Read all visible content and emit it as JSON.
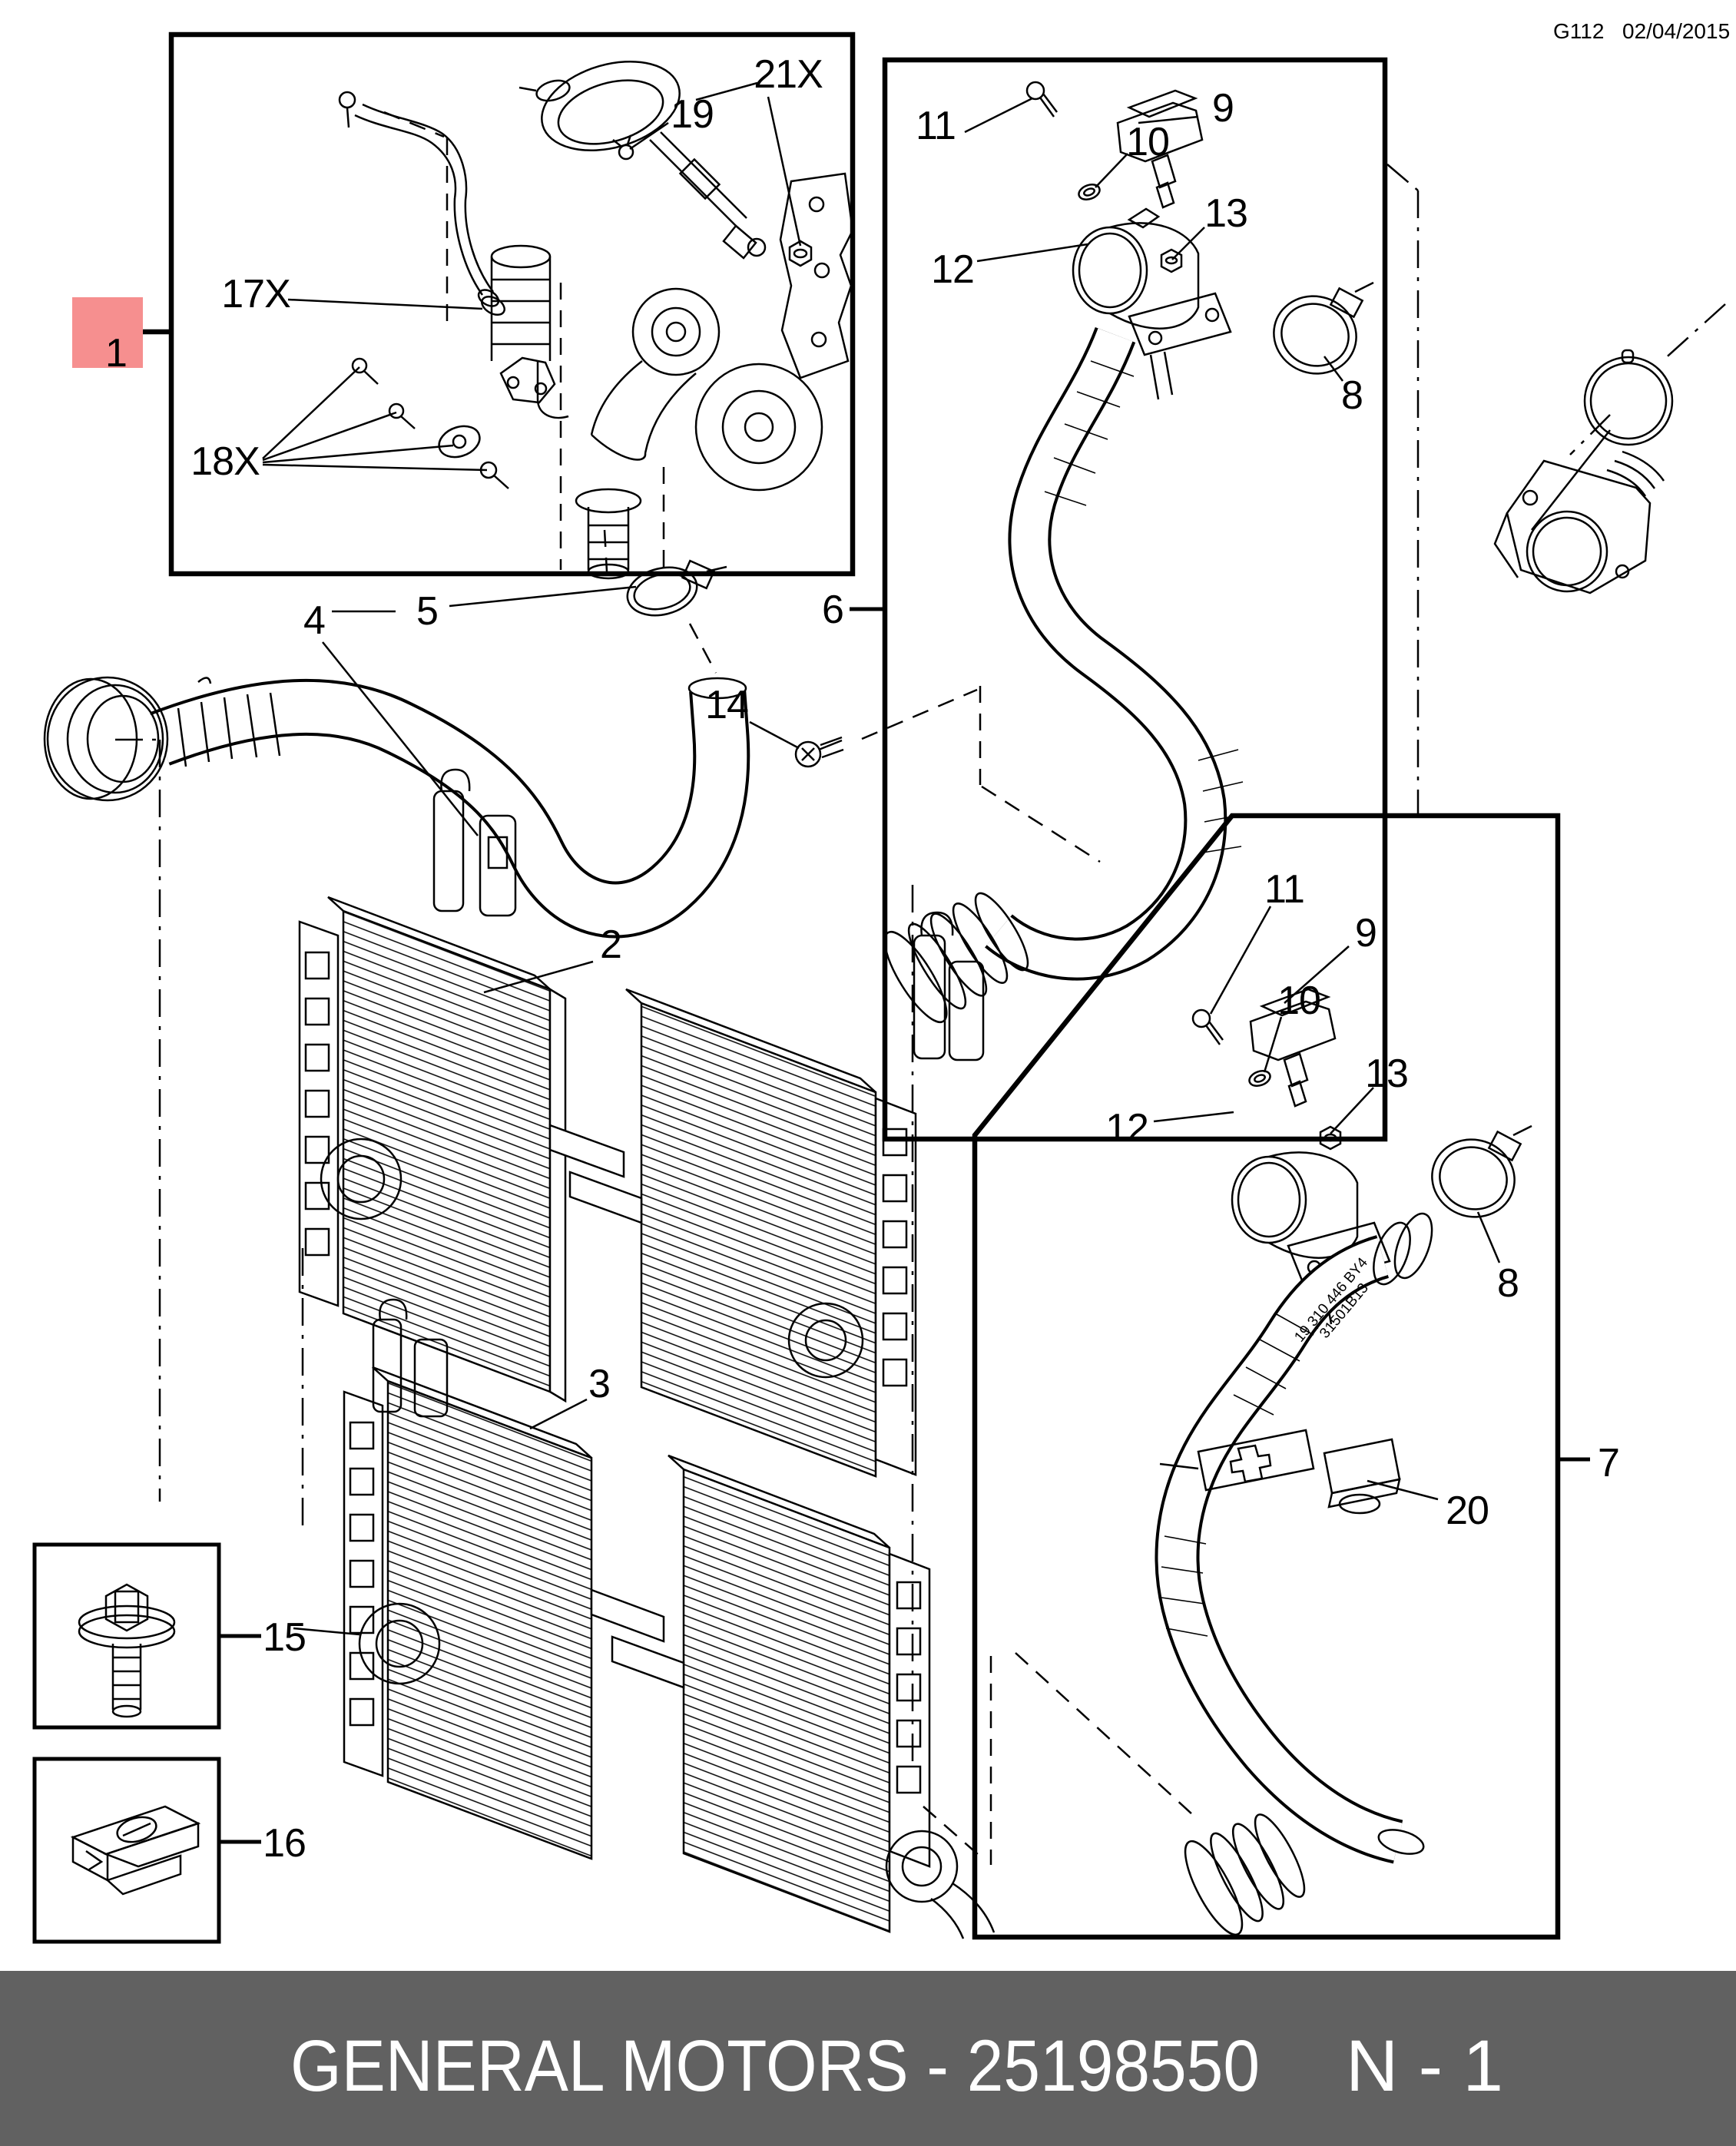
{
  "header": {
    "code": "G112",
    "date": "02/04/2015"
  },
  "footer": {
    "brand_part": "GENERAL MOTORS - 25198550",
    "page": "N - 1",
    "bg": "#616161",
    "fg": "#ffffff"
  },
  "highlight": {
    "box_color": "#f68f8f",
    "text_color": "#7a1414"
  },
  "hose_print": {
    "line1": "19 310 446 BY4",
    "line2": "31501B13"
  },
  "callouts": {
    "c1": "1",
    "c17x": "17X",
    "c18x": "18X",
    "c21x": "21X",
    "c19": "19",
    "c4": "4",
    "c5": "5",
    "c2": "2",
    "c3": "3",
    "c6": "6",
    "c14": "14",
    "c15": "15",
    "c16": "16",
    "c20": "20",
    "c7": "7",
    "p6_11": "11",
    "p6_9": "9",
    "p6_10": "10",
    "p6_12": "12",
    "p6_13": "13",
    "p6_8": "8",
    "p7_11": "11",
    "p7_9": "9",
    "p7_10": "10",
    "p7_12": "12",
    "p7_13": "13",
    "p7_8": "8"
  }
}
